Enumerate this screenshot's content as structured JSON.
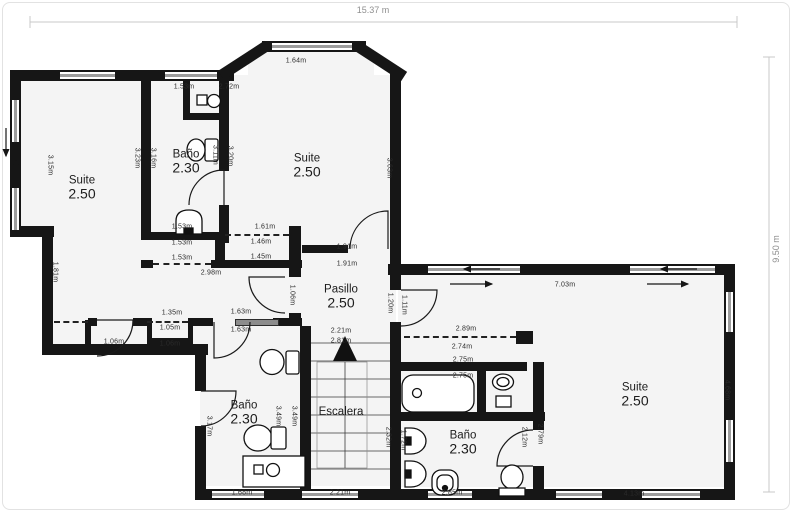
{
  "plan": {
    "total_width_label": "15.37 m",
    "total_height_label": "9.50 m",
    "rooms": [
      {
        "name": "Suite",
        "size": "2.50",
        "x": 82,
        "y": 182
      },
      {
        "name": "Baño",
        "size": "2.30",
        "x": 186,
        "y": 156
      },
      {
        "name": "Suite",
        "size": "2.50",
        "x": 307,
        "y": 160
      },
      {
        "name": "Pasillo",
        "size": "2.50",
        "x": 341,
        "y": 291
      },
      {
        "name": "Escalera",
        "size": "",
        "x": 341,
        "y": 412
      },
      {
        "name": "Baño",
        "size": "2.30",
        "x": 244,
        "y": 407
      },
      {
        "name": "Baño",
        "size": "2.30",
        "x": 463,
        "y": 437
      },
      {
        "name": "Suite",
        "size": "2.50",
        "x": 635,
        "y": 389
      }
    ],
    "dimensions": [
      {
        "t": "2.72m",
        "x": 229,
        "y": 87,
        "v": 0
      },
      {
        "t": "1.53m",
        "x": 184,
        "y": 87,
        "v": 0
      },
      {
        "t": "1.64m",
        "x": 296,
        "y": 61,
        "v": 0
      },
      {
        "t": "3.15m",
        "x": 50,
        "y": 165,
        "v": 1
      },
      {
        "t": "3.23m",
        "x": 137,
        "y": 158,
        "v": 1
      },
      {
        "t": "3.16m",
        "x": 153,
        "y": 158,
        "v": 1
      },
      {
        "t": "3.11m",
        "x": 215,
        "y": 155,
        "v": 1
      },
      {
        "t": "3.20m",
        "x": 230,
        "y": 156,
        "v": 1
      },
      {
        "t": "3.63m",
        "x": 389,
        "y": 168,
        "v": 1
      },
      {
        "t": "1.53m",
        "x": 182,
        "y": 227,
        "v": 0
      },
      {
        "t": "1.61m",
        "x": 265,
        "y": 227,
        "v": 0
      },
      {
        "t": "1.53m",
        "x": 182,
        "y": 243,
        "v": 0
      },
      {
        "t": "1.46m",
        "x": 261,
        "y": 242,
        "v": 0
      },
      {
        "t": "1.53m",
        "x": 182,
        "y": 258,
        "v": 0
      },
      {
        "t": "1.45m",
        "x": 261,
        "y": 257,
        "v": 0
      },
      {
        "t": "2.98m",
        "x": 211,
        "y": 273,
        "v": 0
      },
      {
        "t": "1.91m",
        "x": 347,
        "y": 247,
        "v": 0
      },
      {
        "t": "1.91m",
        "x": 347,
        "y": 264,
        "v": 0
      },
      {
        "t": "1.81m",
        "x": 55,
        "y": 272,
        "v": 1
      },
      {
        "t": "1.06m",
        "x": 292,
        "y": 295,
        "v": 1
      },
      {
        "t": "1.20m",
        "x": 390,
        "y": 303,
        "v": 1
      },
      {
        "t": "1.11m",
        "x": 404,
        "y": 305,
        "v": 1
      },
      {
        "t": "7.03m",
        "x": 565,
        "y": 285,
        "v": 0
      },
      {
        "t": "2.89m",
        "x": 466,
        "y": 329,
        "v": 0
      },
      {
        "t": "2.74m",
        "x": 462,
        "y": 347,
        "v": 0
      },
      {
        "t": "2.75m",
        "x": 463,
        "y": 360,
        "v": 0
      },
      {
        "t": "2.75m",
        "x": 463,
        "y": 376,
        "v": 0
      },
      {
        "t": "1.35m",
        "x": 172,
        "y": 313,
        "v": 0
      },
      {
        "t": "1.05m",
        "x": 170,
        "y": 328,
        "v": 0
      },
      {
        "t": "1.06m",
        "x": 170,
        "y": 344,
        "v": 0
      },
      {
        "t": "1.06m",
        "x": 114,
        "y": 342,
        "v": 0
      },
      {
        "t": "1.63m",
        "x": 241,
        "y": 312,
        "v": 0
      },
      {
        "t": "1.63m",
        "x": 241,
        "y": 330,
        "v": 0
      },
      {
        "t": "2.21m",
        "x": 341,
        "y": 331,
        "v": 0
      },
      {
        "t": "2.81m",
        "x": 341,
        "y": 341,
        "v": 0
      },
      {
        "t": "3.17m",
        "x": 209,
        "y": 426,
        "v": 1
      },
      {
        "t": "3.49m",
        "x": 278,
        "y": 416,
        "v": 1
      },
      {
        "t": "3.49m",
        "x": 294,
        "y": 416,
        "v": 1
      },
      {
        "t": "2.32m",
        "x": 388,
        "y": 437,
        "v": 1
      },
      {
        "t": "1.72m",
        "x": 403,
        "y": 440,
        "v": 1
      },
      {
        "t": "2.21m",
        "x": 340,
        "y": 493,
        "v": 0
      },
      {
        "t": "1.68m",
        "x": 242,
        "y": 493,
        "v": 0
      },
      {
        "t": "2.85m",
        "x": 452,
        "y": 493,
        "v": 0
      },
      {
        "t": "4.13m",
        "x": 634,
        "y": 494,
        "v": 0
      },
      {
        "t": "2.12m",
        "x": 524,
        "y": 437,
        "v": 1
      },
      {
        "t": "2.79m",
        "x": 540,
        "y": 434,
        "v": 1
      },
      {
        "t": "4.68m",
        "x": 727,
        "y": 390,
        "v": 1
      }
    ]
  }
}
